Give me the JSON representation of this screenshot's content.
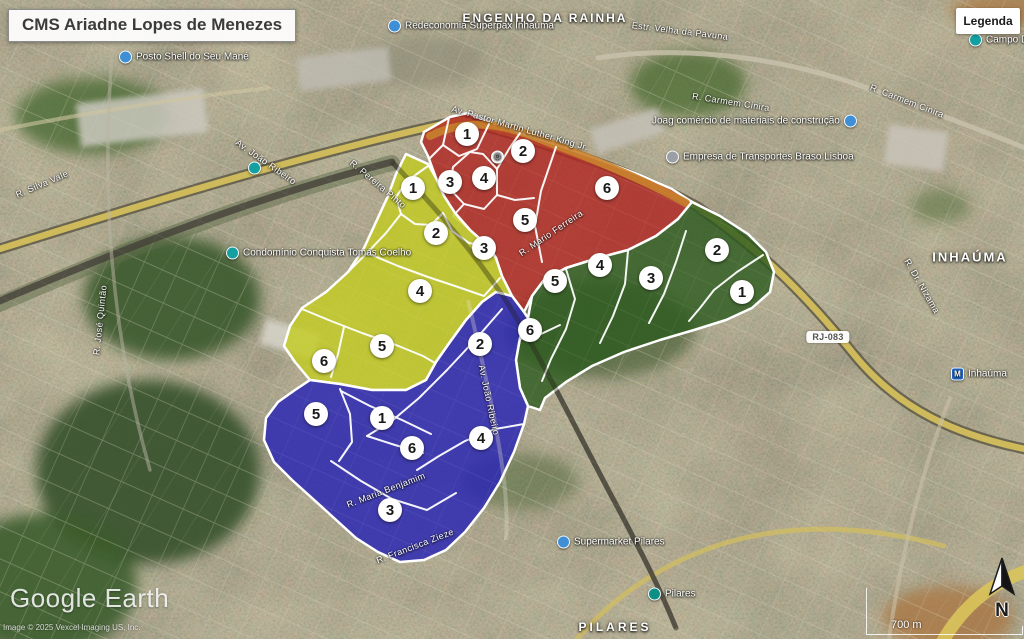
{
  "title": "CMS Ariadne Lopes de Menezes",
  "legend_button": "Legenda",
  "watermark": {
    "brand": "Google Earth",
    "credit": "Image © 2025 Vexcel Imaging US, Inc."
  },
  "scale_bar": {
    "label": "700 m"
  },
  "compass": {
    "label": "N"
  },
  "route_badge": {
    "text": "RJ-083",
    "x": 828,
    "y": 337
  },
  "area_labels": [
    {
      "text": "ENGENHO DA RAINHA",
      "x": 545,
      "y": 18,
      "size": 12,
      "spacing": 2
    },
    {
      "text": "INHAÚMA",
      "x": 970,
      "y": 257,
      "size": 13,
      "spacing": 2
    },
    {
      "text": "PILARES",
      "x": 615,
      "y": 627,
      "size": 12,
      "spacing": 3
    }
  ],
  "poi_labels": [
    {
      "text": "Redeconomia Superpax Inhaúma",
      "icon": "dot-blue",
      "x": 388,
      "y": 26,
      "side": "left"
    },
    {
      "text": "Posto Shell do Seu Mané",
      "icon": "dot-blue",
      "x": 119,
      "y": 57,
      "side": "left"
    },
    {
      "text": "Joag comércio de materiais de construção",
      "icon": "dot-blue",
      "x": 652,
      "y": 121,
      "side": "right"
    },
    {
      "text": "Empresa de Transportes Braso Lisboa",
      "icon": "pin-grey",
      "x": 666,
      "y": 157,
      "side": "left"
    },
    {
      "text": "Condomínio Conquista Tomás Coelho",
      "icon": "dot-teal",
      "x": 226,
      "y": 253,
      "side": "left"
    },
    {
      "text": "Supermarket Pilares",
      "icon": "dot-blue",
      "x": 557,
      "y": 542,
      "side": "left"
    },
    {
      "text": "Pilares",
      "icon": "train-teal",
      "x": 648,
      "y": 594,
      "side": "left"
    },
    {
      "text": "Inhaúma",
      "icon": "metro-blue",
      "x": 951,
      "y": 374,
      "side": "left"
    },
    {
      "text": "Campo Da",
      "icon": "dot-teal",
      "x": 969,
      "y": 40,
      "side": "left"
    },
    {
      "text": "",
      "icon": "station-white",
      "x": 491,
      "y": 157,
      "side": "left"
    },
    {
      "text": "",
      "icon": "dot-teal",
      "x": 248,
      "y": 168,
      "side": "left"
    }
  ],
  "street_labels": [
    {
      "text": "Av. Pastor Martin Luther King Jr.",
      "x": 520,
      "y": 128,
      "angle": 16
    },
    {
      "text": "Estr. Velha da Pavuna",
      "x": 680,
      "y": 31,
      "angle": 7
    },
    {
      "text": "R. Carmem Cinira",
      "x": 731,
      "y": 102,
      "angle": 9
    },
    {
      "text": "R. Carmem Cinira",
      "x": 907,
      "y": 101,
      "angle": 21
    },
    {
      "text": "R. Silva Vale",
      "x": 42,
      "y": 184,
      "angle": -23
    },
    {
      "text": "R. José Quintão",
      "x": 100,
      "y": 320,
      "angle": -84
    },
    {
      "text": "Av. João Ribeiro",
      "x": 266,
      "y": 162,
      "angle": 35
    },
    {
      "text": "R. Pereira Pinto",
      "x": 378,
      "y": 184,
      "angle": 40
    },
    {
      "text": "R. Mario Ferreira",
      "x": 551,
      "y": 233,
      "angle": -34
    },
    {
      "text": "Av. João Ribeiro",
      "x": 489,
      "y": 400,
      "angle": 78
    },
    {
      "text": "R. Maria Benjamim",
      "x": 386,
      "y": 490,
      "angle": -21
    },
    {
      "text": "R. Francisca Zieze",
      "x": 415,
      "y": 546,
      "angle": -21
    },
    {
      "text": "R. Dr. Nizama",
      "x": 922,
      "y": 286,
      "angle": 60
    }
  ],
  "zones": [
    {
      "id": "north",
      "color": "#b02420",
      "opacity": 0.8,
      "markers": [
        {
          "n": "1",
          "x": 467,
          "y": 134
        },
        {
          "n": "2",
          "x": 523,
          "y": 151
        },
        {
          "n": "3",
          "x": 450,
          "y": 182
        },
        {
          "n": "4",
          "x": 484,
          "y": 178
        },
        {
          "n": "5",
          "x": 525,
          "y": 220
        },
        {
          "n": "6",
          "x": 607,
          "y": 188
        }
      ]
    },
    {
      "id": "west",
      "color": "#c3cc1f",
      "opacity": 0.8,
      "markers": [
        {
          "n": "1",
          "x": 413,
          "y": 188
        },
        {
          "n": "2",
          "x": 436,
          "y": 233
        },
        {
          "n": "3",
          "x": 484,
          "y": 248
        },
        {
          "n": "4",
          "x": 420,
          "y": 291
        },
        {
          "n": "5",
          "x": 382,
          "y": 346
        },
        {
          "n": "6",
          "x": 324,
          "y": 361
        }
      ]
    },
    {
      "id": "east",
      "color": "#2c5a1e",
      "opacity": 0.8,
      "markers": [
        {
          "n": "1",
          "x": 742,
          "y": 292
        },
        {
          "n": "2",
          "x": 717,
          "y": 250
        },
        {
          "n": "3",
          "x": 651,
          "y": 278
        },
        {
          "n": "4",
          "x": 600,
          "y": 265
        },
        {
          "n": "5",
          "x": 555,
          "y": 281
        },
        {
          "n": "6",
          "x": 530,
          "y": 330
        }
      ]
    },
    {
      "id": "south",
      "color": "#2b27b4",
      "opacity": 0.84,
      "markers": [
        {
          "n": "1",
          "x": 382,
          "y": 418
        },
        {
          "n": "2",
          "x": 480,
          "y": 344
        },
        {
          "n": "3",
          "x": 390,
          "y": 510
        },
        {
          "n": "4",
          "x": 481,
          "y": 438
        },
        {
          "n": "5",
          "x": 316,
          "y": 414
        },
        {
          "n": "6",
          "x": 412,
          "y": 448
        }
      ]
    }
  ],
  "icon_colors": {
    "dot-blue": "#3f8fd6",
    "dot-teal": "#14a0a0",
    "pin-grey": "#9aa0a6",
    "train-teal": "#0d8f86",
    "metro-blue": "#1f66c9",
    "station-white": "#ffffff"
  },
  "highway_highlight_color": "#c8822e"
}
